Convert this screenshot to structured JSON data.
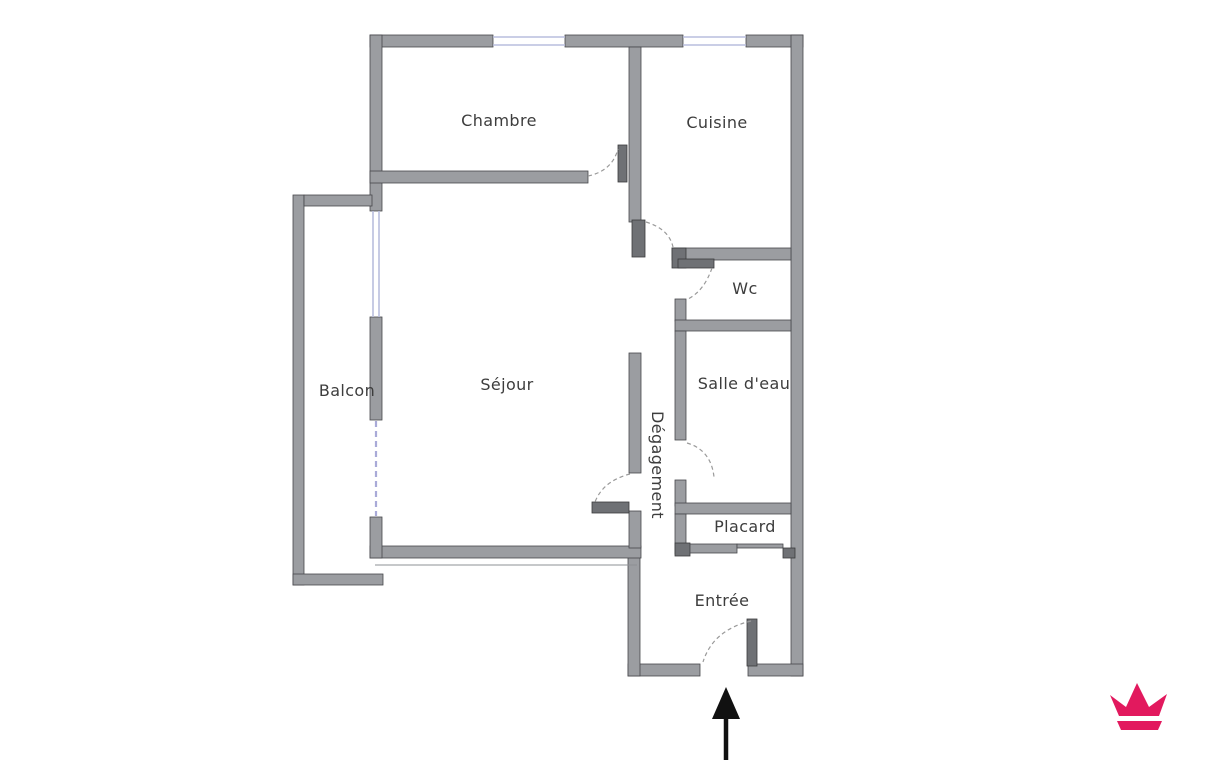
{
  "floor_plan": {
    "rooms": {
      "chambre": {
        "label": "Chambre"
      },
      "cuisine": {
        "label": "Cuisine"
      },
      "balcon": {
        "label": "Balcon"
      },
      "sejour": {
        "label": "Séjour"
      },
      "wc": {
        "label": "Wc"
      },
      "salle_deau": {
        "label": "Salle d'eau"
      },
      "degagement": {
        "label": "Dégagement"
      },
      "placard": {
        "label": "Placard"
      },
      "entree": {
        "label": "Entrée"
      }
    },
    "colors": {
      "background": "#ffffff",
      "wall": "#9b9da1",
      "wall_edge": "#47484c",
      "door_leaf": "#6f7175",
      "door_arc": "#9a9a9a",
      "window": "#b9bedd",
      "window_sliding": "#a9aad8",
      "label_text": "#3d3d3d",
      "entrance_arrow": "#111111",
      "logo": "#e2195e"
    },
    "icons": {
      "entrance_arrow": "arrow-up",
      "logo": "crown"
    }
  }
}
